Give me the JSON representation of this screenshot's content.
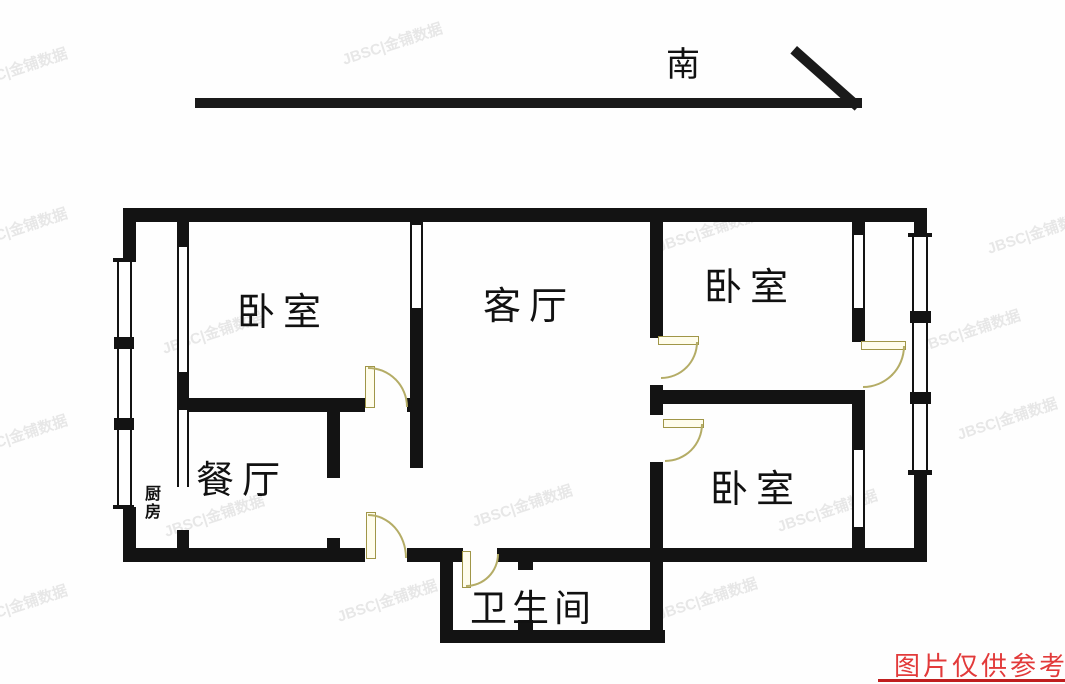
{
  "title": "户型图",
  "compass": {
    "label": "南"
  },
  "rooms": [
    {
      "id": "bedroom-nw",
      "label": "卧室"
    },
    {
      "id": "living",
      "label": "客厅"
    },
    {
      "id": "bedroom-ne",
      "label": "卧室"
    },
    {
      "id": "bedroom-se",
      "label": "卧室"
    },
    {
      "id": "dining",
      "label": "餐厅"
    },
    {
      "id": "kitchen",
      "label": "厨房"
    },
    {
      "id": "bathroom",
      "label": "卫生间"
    }
  ],
  "watermark": {
    "text": "JBSC|金铺数据"
  },
  "disclaimer": {
    "text": "图片仅供参考"
  },
  "colors": {
    "wall": "#131313",
    "door_line": "#b4ac66",
    "door_fill": "#fffdec",
    "disclaimer_red": "#e23a3a",
    "background": "#fefefe"
  }
}
